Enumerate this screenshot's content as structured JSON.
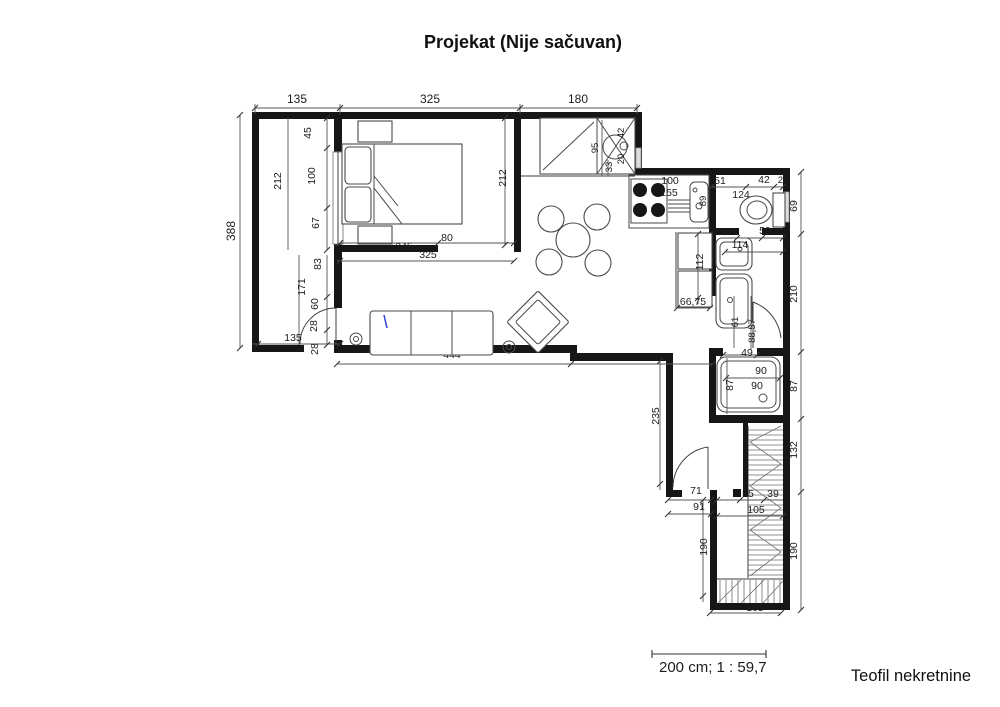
{
  "title": "Projekat (Nije sačuvan)",
  "footer": {
    "scale_label": "200 cm; 1 : 59,7",
    "agency": "Teofil nekretnine"
  },
  "dims": {
    "t135": "135",
    "t325": "325",
    "t180": "180",
    "l388": "388",
    "tr45": "45",
    "tr100": "100",
    "tr212": "212",
    "tr67": "67",
    "tr83": "83",
    "tr171": "171",
    "tr60": "60",
    "tr28": "28",
    "tr28b": "28",
    "tr135": "135",
    "br212": "212",
    "br245": "245",
    "br80": "80",
    "br325": "325",
    "cl95": "95",
    "cl42": "42",
    "cl20": "20",
    "cl33": "33",
    "k100": "100",
    "k155": "155",
    "k89": "89",
    "wc51": "51",
    "wc42": "42",
    "wc21": "21",
    "wc124": "124",
    "wc59": "59",
    "wc114": "114",
    "r69": "69",
    "r210": "210",
    "r87": "87",
    "r132": "132",
    "r190": "190",
    "n112": "112",
    "n6675": "66,75",
    "b61": "61",
    "b8857": "88,57",
    "b49": "49",
    "s87": "87",
    "s90a": "90",
    "s90b": "90",
    "h235": "235",
    "h71": "71",
    "h91": "91",
    "h55": "55",
    "h39": "39",
    "h105": "105",
    "bt190": "190",
    "bt105": "105",
    "lv444": "444",
    "lv403": "403"
  }
}
